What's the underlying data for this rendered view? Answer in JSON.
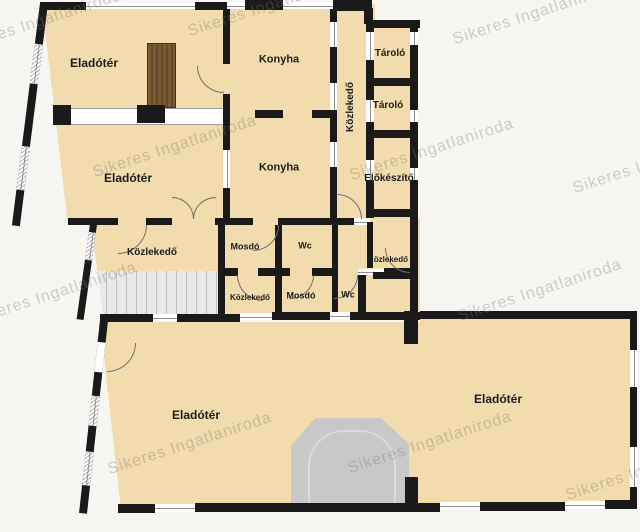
{
  "watermark": {
    "text": "Sikeres Ingatlaniroda"
  },
  "colors": {
    "background": "#f7f6f3",
    "room-fill": "#f2dbac",
    "wall": "#1a1a1a",
    "window-line": "#8f8f8f",
    "door-line": "#6f6f6f",
    "partition-line": "#9a9a9a",
    "stairs-fill": "#e9e9e9",
    "stairs-line": "#bdbdbd",
    "entrance-fill": "#c8c8c8",
    "entrance-line": "#dadada",
    "furniture": "#7b5a33",
    "furniture-dark": "#66482a",
    "label": "#1d1d1d",
    "watermark-color": "rgba(120,120,120,0.34)"
  },
  "rooms": [
    {
      "id": "eladoter-upper-left",
      "label": "Eladótér"
    },
    {
      "id": "eladoter-mid-left",
      "label": "Eladótér"
    },
    {
      "id": "konyha-upper",
      "label": "Konyha"
    },
    {
      "id": "konyha-lower",
      "label": "Konyha"
    },
    {
      "id": "kozlekedo-corridor",
      "label": "Közlekedő"
    },
    {
      "id": "tarolo-upper",
      "label": "Tároló"
    },
    {
      "id": "tarolo-lower",
      "label": "Tároló"
    },
    {
      "id": "elokeszito",
      "label": "Előkészítő"
    },
    {
      "id": "kozlekedo-west",
      "label": "Közlekedő"
    },
    {
      "id": "mosdo-north",
      "label": "Mosdó"
    },
    {
      "id": "wc-north",
      "label": "Wc"
    },
    {
      "id": "kozlekedo-east",
      "label": "Közlekedő"
    },
    {
      "id": "kozlekedo-south",
      "label": "Közlekedő"
    },
    {
      "id": "mosdo-south",
      "label": "Mosdó"
    },
    {
      "id": "wc-south",
      "label": "Wc"
    },
    {
      "id": "eladoter-southwest",
      "label": "Eladótér"
    },
    {
      "id": "eladoter-southeast",
      "label": "Eladótér"
    }
  ]
}
